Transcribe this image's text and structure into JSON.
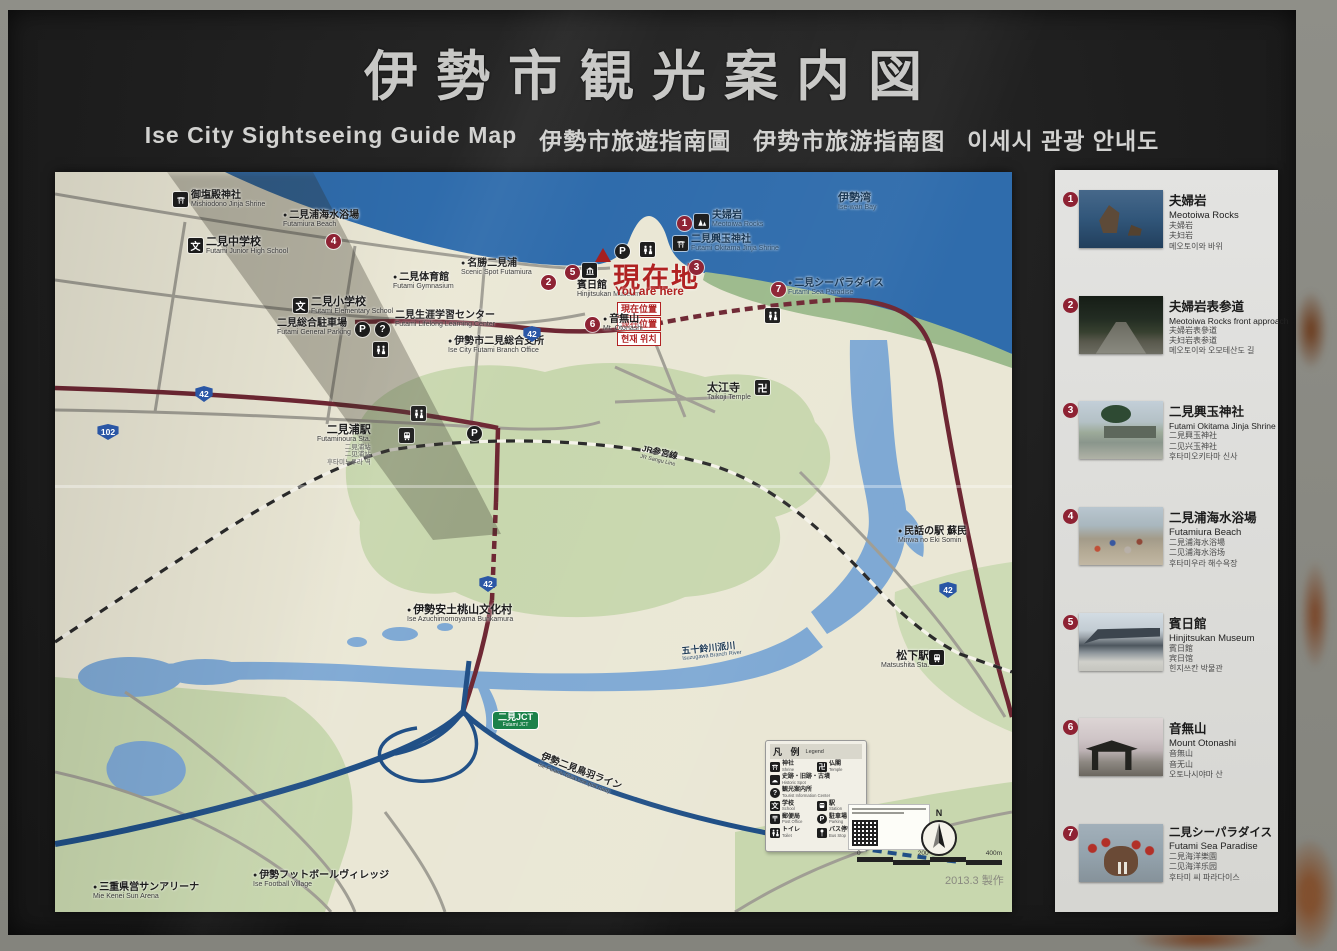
{
  "board": {
    "title": "伊勢市観光案内図",
    "subtitle_en": "Ise City Sightseeing Guide Map",
    "subtitle_zh_t": "伊勢市旅遊指南圖",
    "subtitle_zh_s": "伊势市旅游指南图",
    "subtitle_ko": "이세시 관광 안내도"
  },
  "icons": {
    "parking": "P",
    "info": "?",
    "school": "文",
    "post": "〒",
    "temple": "卍"
  },
  "map": {
    "you_are_here": {
      "jp": "現在地",
      "en": "You are here",
      "zh_t": "現在位置",
      "zh_s": "现在位置",
      "ko": "현재 위치"
    },
    "shield_42": "42",
    "shield_102": "102",
    "compass_n": "N",
    "scale": {
      "t0": "0",
      "t200": "200",
      "t400": "400m"
    },
    "credit": "2013.3 製作",
    "jct": {
      "jp": "二見JCT",
      "en": "Futami JCT"
    },
    "labels": {
      "ise_bay": {
        "jp": "伊勢湾",
        "en": "Ise-wan Bay"
      },
      "mishiodono": {
        "jp": "御塩殿神社",
        "en": "Mishiodono Jinja Shrine"
      },
      "futami_jhs": {
        "jp": "二見中学校",
        "en": "Futami Junior High School"
      },
      "futamiura_beach": {
        "jp": "二見浦海水浴場",
        "en": "Futamiura Beach"
      },
      "futami_gym": {
        "jp": "二見体育館",
        "en": "Futami Gymnasium"
      },
      "futami_es": {
        "jp": "二見小学校",
        "en": "Futami Elementary School"
      },
      "futami_parking": {
        "jp": "二見総合駐車場",
        "en": "Futami General Parking"
      },
      "lifelong": {
        "jp": "二見生涯学習センター",
        "en": "Futami Lifelong Learning Center"
      },
      "branch_office": {
        "jp": "伊勢市二見総合支所",
        "en": "Ise City Futami Branch Office"
      },
      "scenic": {
        "jp": "名勝二見浦",
        "en": "Scenic Spot Futamiura"
      },
      "hinjitsukan": {
        "jp": "賓日館",
        "en": "Hinjitsukan Museum"
      },
      "meotoiwa": {
        "jp": "夫婦岩",
        "en": "Meotoiwa Rocks"
      },
      "okitama": {
        "jp": "二見興玉神社",
        "en": "Futami Okitama Jinja Shrine"
      },
      "otonashi": {
        "jp": "音無山",
        "en": "Mt. Otonashi"
      },
      "seaparadise": {
        "jp": "二見シーパラダイス",
        "en": "Futami Sea Paradise"
      },
      "taikoji": {
        "jp": "太江寺",
        "en": "Taikoji Temple"
      },
      "futaminoura_sta": {
        "jp": "二見浦駅",
        "en": "Futaminoura Sta.",
        "zh_t": "二見浦站",
        "zh_s": "二见浦站",
        "ko": "후타미노우라 역"
      },
      "jr_line": {
        "jp": "JR参宮線",
        "en": "JR Sangu Line"
      },
      "minwa": {
        "jp": "民話の駅 蘇民",
        "en": "Minwa no Eki Somin"
      },
      "bunkamura": {
        "jp": "伊勢安土桃山文化村",
        "en": "Ise Azuchimomoyama Bunkamura"
      },
      "isuzu": {
        "jp": "五十鈴川派川",
        "en": "Isuzugawa Branch River"
      },
      "toba_line": {
        "jp": "伊勢二見鳥羽ライン",
        "en": "Ise-Futami-Toba Line (toll road)"
      },
      "matsushita": {
        "jp": "松下駅",
        "en": "Matsushita Sta."
      },
      "sun_arena": {
        "jp": "三重県営サンアリーナ",
        "en": "Mie Kenei Sun Arena"
      },
      "football": {
        "jp": "伊勢フットボールヴィレッジ",
        "en": "Ise Football Village"
      }
    }
  },
  "legend": {
    "title_jp": "凡 例",
    "title_en": "Legend",
    "items": [
      {
        "icon": "torii-icon",
        "jp": "神社",
        "en": "Shrine"
      },
      {
        "icon": "temple-icon",
        "jp": "仏閣",
        "en": "Temple"
      },
      {
        "icon": "historic-icon",
        "jp": "史跡・旧跡・古墳",
        "en": "Historic Spot"
      },
      {
        "icon": "info-icon",
        "jp": "観光案内所",
        "en": "Tourist Information Center"
      },
      {
        "icon": "school-icon",
        "jp": "学校",
        "en": "School"
      },
      {
        "icon": "station-icon",
        "jp": "駅",
        "en": "Station"
      },
      {
        "icon": "post-icon",
        "jp": "郵便局",
        "en": "Post Office"
      },
      {
        "icon": "parking-icon",
        "jp": "駐車場",
        "en": "Parking"
      },
      {
        "icon": "toilet-icon",
        "jp": "トイレ",
        "en": "Toilet"
      },
      {
        "icon": "busstop-icon",
        "jp": "バス停留所",
        "en": "Bus Stop"
      }
    ]
  },
  "sidebar": {
    "items": [
      {
        "num": "1",
        "jp": "夫婦岩",
        "en": "Meotoiwa Rocks",
        "zh_t": "夫婦岩",
        "zh_s": "夫妇岩",
        "ko": "메오토이와 바위",
        "photo": "Meotoiwa wedded rocks in the sea"
      },
      {
        "num": "2",
        "jp": "夫婦岩表参道",
        "en": "Meotoiwa Rocks front approach",
        "zh_t": "夫婦岩表參道",
        "zh_s": "夫妇岩表参道",
        "ko": "메오토이와 오모테산도 길",
        "photo": "tree-lined approach road"
      },
      {
        "num": "3",
        "jp": "二見興玉神社",
        "en": "Futami Okitama Jinja Shrine",
        "zh_t": "二見興玉神社",
        "zh_s": "二见兴玉神社",
        "ko": "후타미오키타마 신사",
        "photo": "shrine buildings by the shore"
      },
      {
        "num": "4",
        "jp": "二見浦海水浴場",
        "en": "Futamiura Beach",
        "zh_t": "二見浦海水浴場",
        "zh_s": "二见浦海水浴场",
        "ko": "후타미우라 해수욕장",
        "photo": "crowded swimming beach"
      },
      {
        "num": "5",
        "jp": "賓日館",
        "en": "Hinjitsukan Museum",
        "zh_t": "賓日館",
        "zh_s": "宾日馆",
        "ko": "힌지쓰칸 박물관",
        "photo": "historic building with tiled roof"
      },
      {
        "num": "6",
        "jp": "音無山",
        "en": "Mount Otonashi",
        "zh_t": "音無山",
        "zh_s": "音无山",
        "ko": "오토나시야마 산",
        "photo": "pavilion under cherry blossoms"
      },
      {
        "num": "7",
        "jp": "二見シーパラダイス",
        "en": "Futami Sea Paradise",
        "zh_t": "二見海洋樂園",
        "zh_s": "二见海洋乐园",
        "ko": "후타미 씨 파라다이스",
        "photo": "walrus with visitors"
      }
    ]
  }
}
